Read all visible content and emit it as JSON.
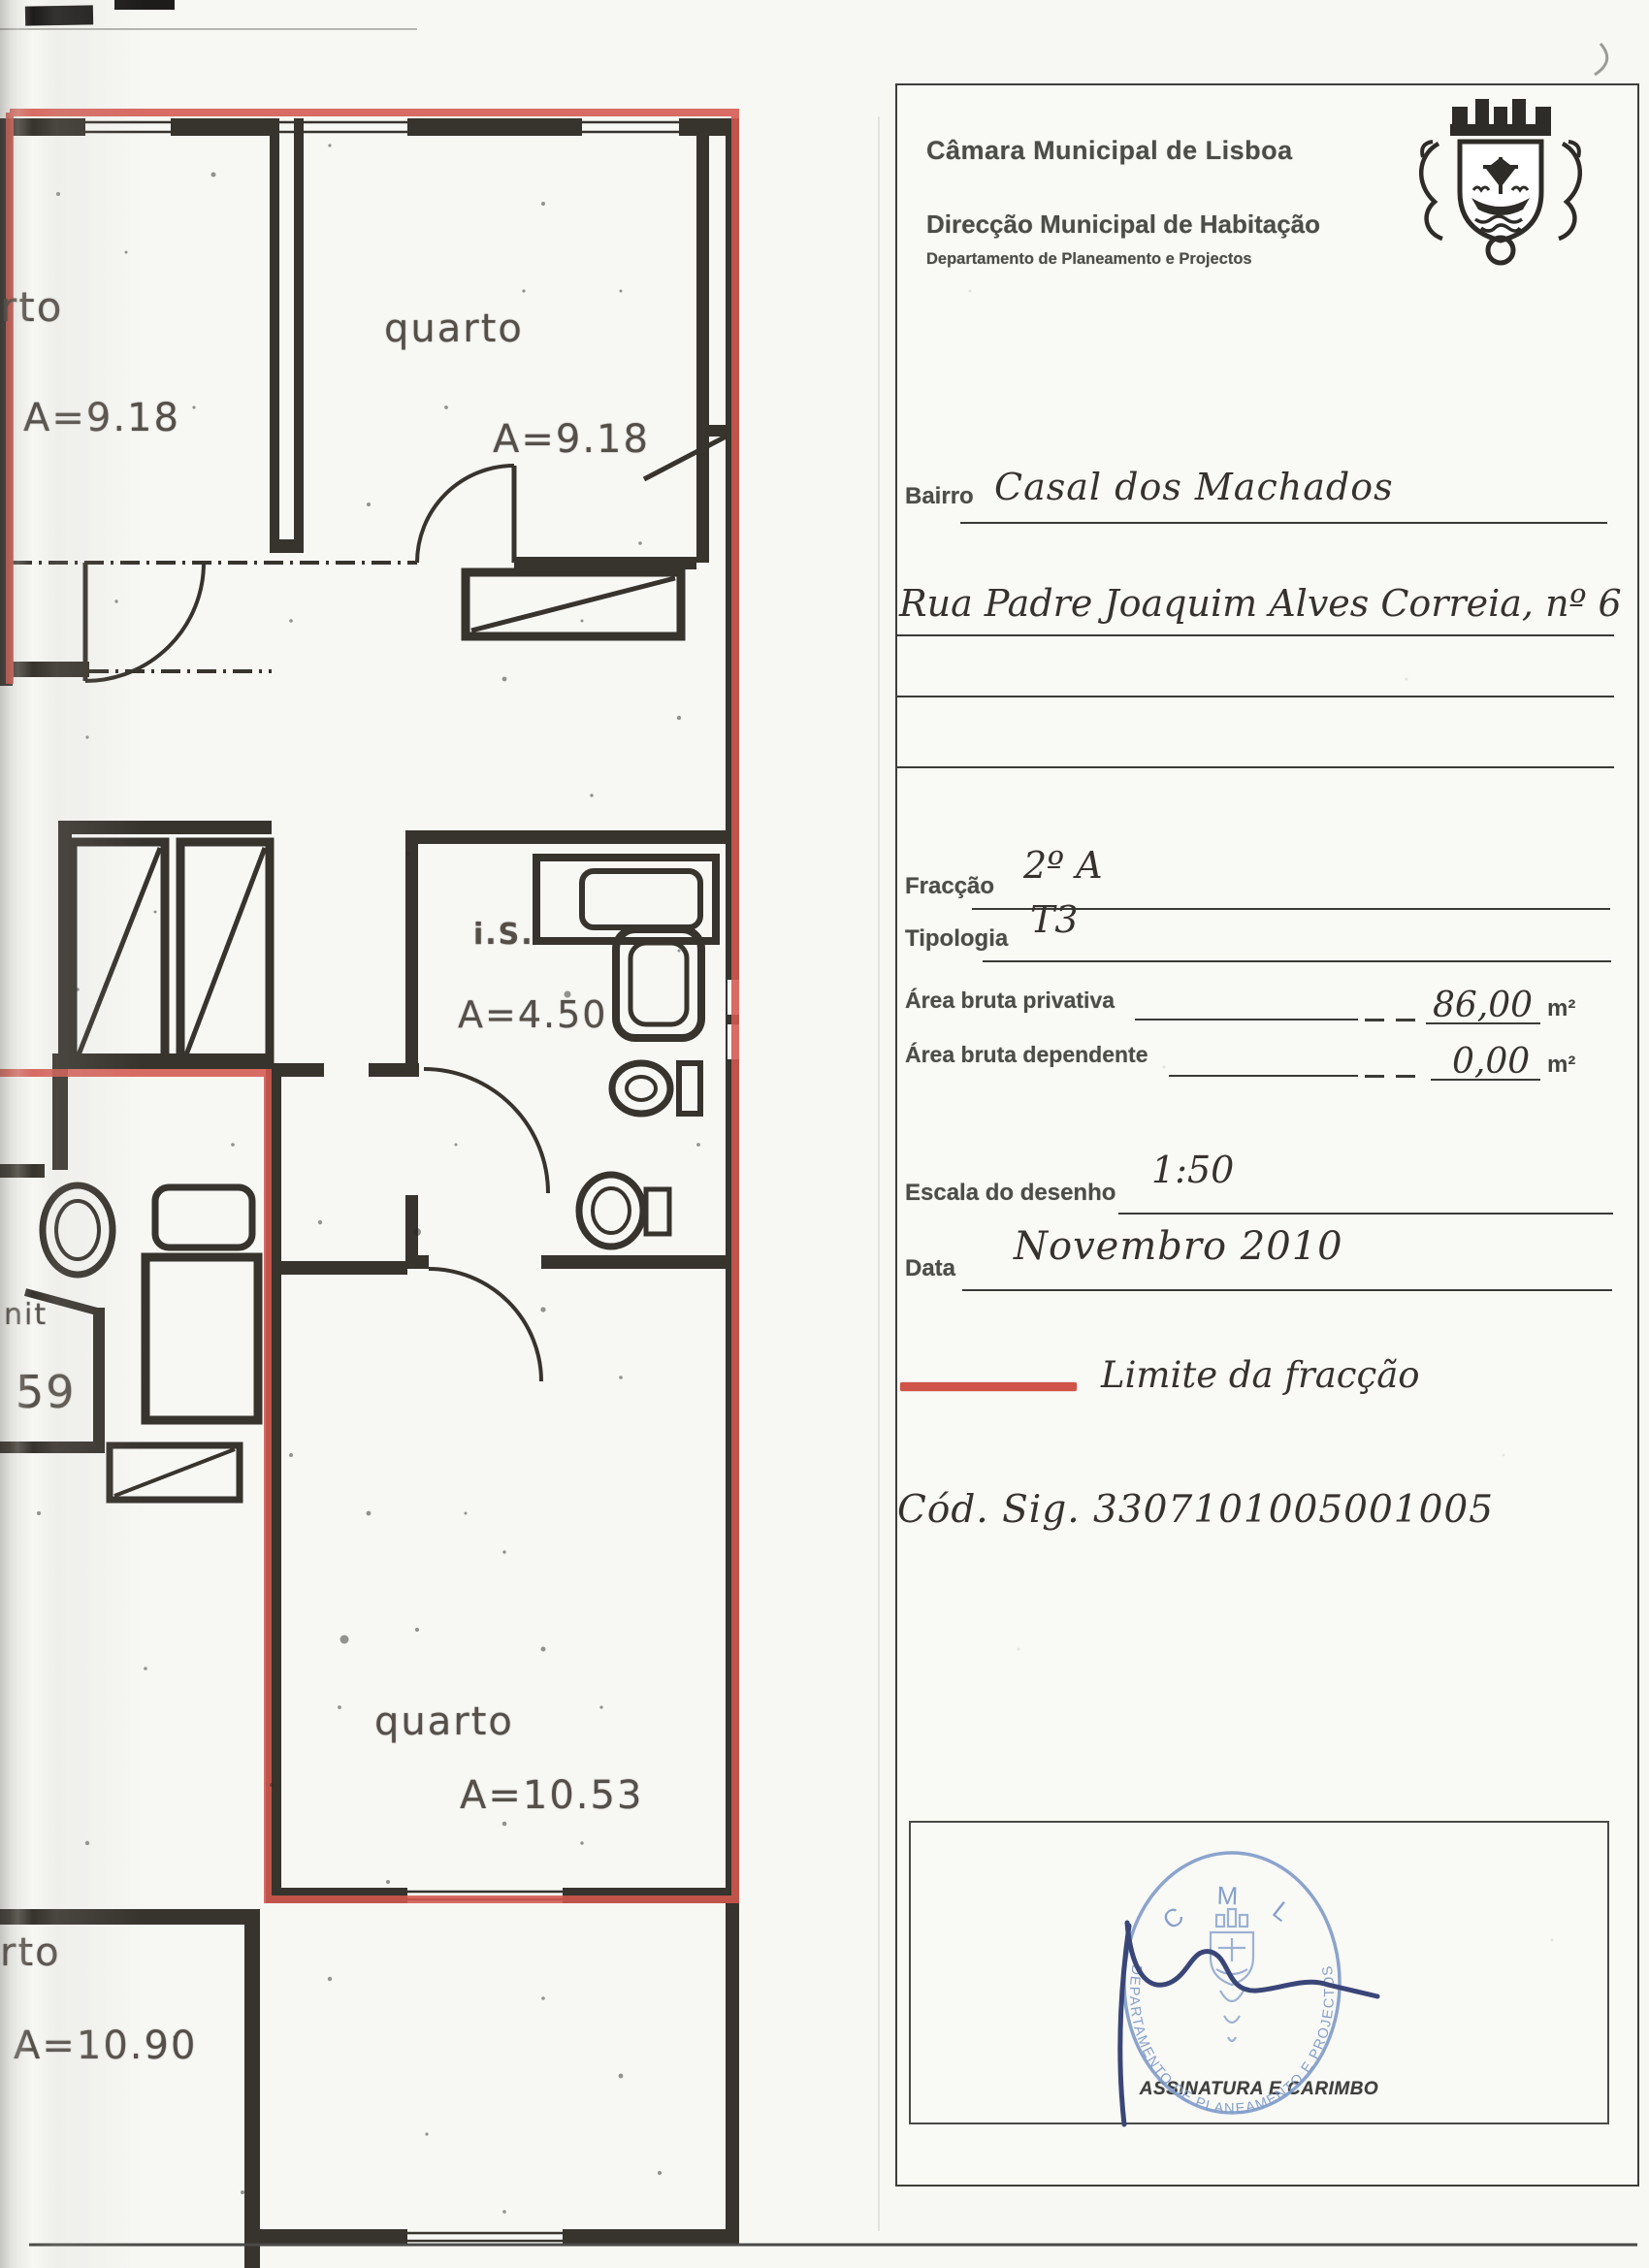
{
  "header": {
    "org": "Câmara Municipal de Lisboa",
    "direction": "Direcção Municipal de Habitação",
    "department": "Departamento de Planeamento e Projectos"
  },
  "icons": {
    "crest": "lisbon-coat-of-arms",
    "stamp": "cml-round-stamp"
  },
  "form": {
    "bairro": {
      "label": "Bairro",
      "value": "Casal dos Machados"
    },
    "endereco": {
      "value": "Rua Padre Joaquim Alves Correia, nº 6"
    },
    "fraccao": {
      "label": "Fracção",
      "value": "2º A"
    },
    "tipologia": {
      "label": "Tipologia",
      "value": "T3"
    },
    "area_privativa": {
      "label": "Área bruta privativa",
      "value": "86,00",
      "unit": "m²"
    },
    "area_dependente": {
      "label": "Área bruta dependente",
      "value": "0,00",
      "unit": "m²"
    },
    "escala": {
      "label": "Escala do desenho",
      "value": "1:50"
    },
    "data": {
      "label": "Data",
      "value": "Novembro 2010"
    },
    "legend": {
      "label": "Limite da fracção",
      "color": "#cf5349"
    },
    "cod_sig": "Cód. Sig. 3307101005001005"
  },
  "signature_area": {
    "caption": "ASSINATURA E CARIMBO",
    "stamp": {
      "top_text": "C M L",
      "ring_text": "DEPARTAMENTO DE PLANEAMENTO E PROJECTOS",
      "color": "#7f9bc9"
    }
  },
  "plan": {
    "boundary_color": "#d4584e",
    "wall_color": "#37332d",
    "labels": [
      {
        "text": "rto"
      },
      {
        "text": "A=9.18"
      },
      {
        "text": "quarto"
      },
      {
        "text": "A=9.18"
      },
      {
        "text": "i.S."
      },
      {
        "text": "A=4.50"
      },
      {
        "text": "nit"
      },
      {
        "text": "59"
      },
      {
        "text": "quarto"
      },
      {
        "text": "A=10.53"
      },
      {
        "text": "rto"
      },
      {
        "text": "A=10.90"
      }
    ]
  }
}
